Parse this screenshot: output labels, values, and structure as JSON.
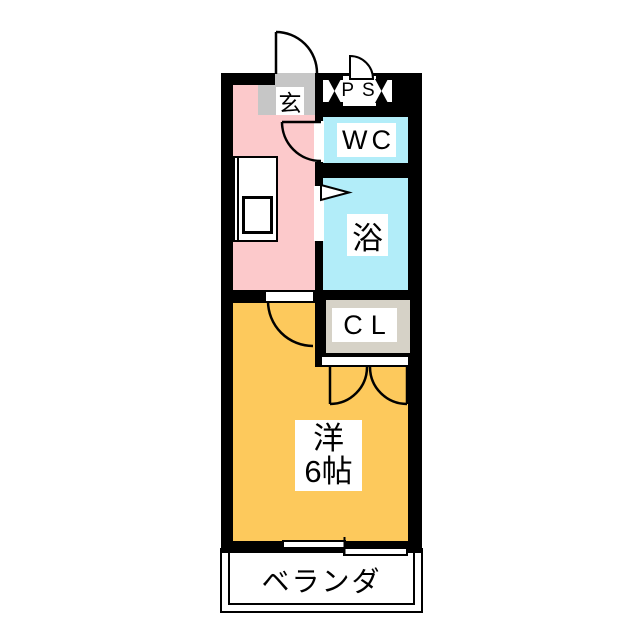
{
  "labels": {
    "entrance": "玄",
    "pipe_space": "PS",
    "toilet": "WC",
    "bath": "浴",
    "closet": "CL",
    "main_room_line1": "洋",
    "main_room_line2": "6帖",
    "veranda": "ベランダ"
  },
  "colors": {
    "wall": "#000000",
    "kitchen_hall_fill": "#fcc9cb",
    "wet_area_fill": "#b2edf9",
    "main_room_fill": "#fdc95c",
    "entrance_step_fill": "#c6c6c6",
    "closet_fill": "#d6d2c7",
    "label_box_fill": "#ffffff"
  }
}
